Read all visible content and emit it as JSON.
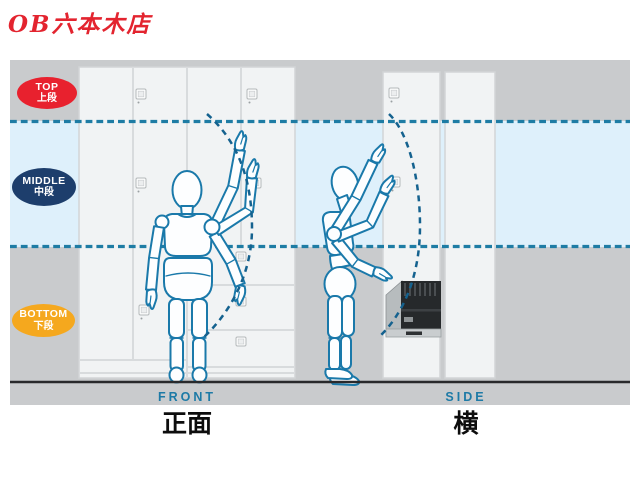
{
  "title": "OB六本木店",
  "zones": [
    {
      "id": "top",
      "label_en": "TOP",
      "label_ja": "上段",
      "color": "#e8212e"
    },
    {
      "id": "middle",
      "label_en": "MIDDLE",
      "label_ja": "中段",
      "color": "#1d3e6c"
    },
    {
      "id": "bottom",
      "label_en": "BOTTOM",
      "label_ja": "下段",
      "color": "#f5a81e"
    }
  ],
  "views": [
    {
      "id": "front",
      "label_en": "FRONT",
      "label_ja": "正面"
    },
    {
      "id": "side",
      "label_en": "SIDE",
      "label_ja": "横"
    }
  ],
  "diagram_colors": {
    "background_gray": "#c9cbcd",
    "middle_band": "#def0fb",
    "zone_dashed_line": "#1e7ca4",
    "reach_arc": "#15628f",
    "figure_outline": "#1a79aa",
    "cabinet_white": "#f1f3f4",
    "ground_line": "#28292b",
    "title_red": "#e3242f"
  }
}
